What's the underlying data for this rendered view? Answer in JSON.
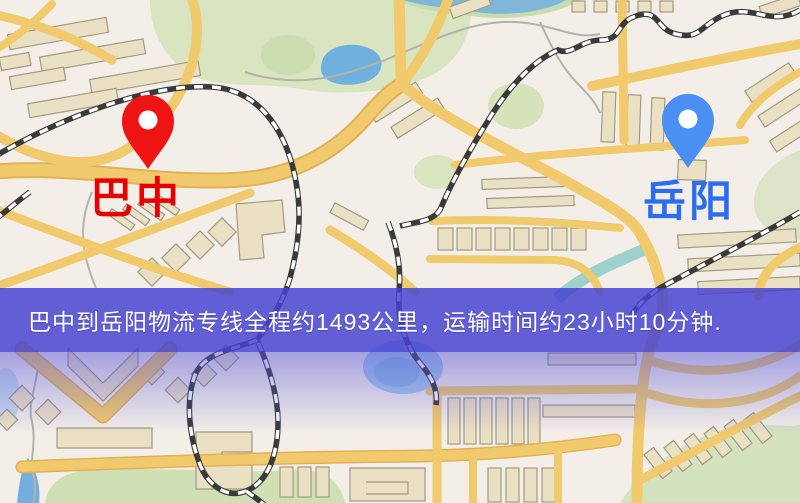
{
  "page": {
    "width_px": 800,
    "height_px": 503,
    "kind": "logistics route map image"
  },
  "map": {
    "markers": [
      {
        "id": "origin",
        "label": "巴中",
        "pin_color": "#ee1414",
        "label_color": "#e60202",
        "pin_style": "red teardrop with white hole"
      },
      {
        "id": "destination",
        "label": "岳阳",
        "pin_color": "#4a90f2",
        "label_color": "#2b6cf0",
        "pin_style": "blue teardrop with white hole"
      }
    ],
    "palette": {
      "background": "#f3efe8",
      "road": "#f0ca6c",
      "park": "#d9e4c0",
      "water": "#6fb0df",
      "building": "#eae0c4",
      "railway": "#3a3a3a"
    }
  },
  "banner": {
    "text": "巴中到岳阳物流专线全程约1493公里，运输时间约23小时10分钟.",
    "origin": "巴中",
    "destination": "岳阳",
    "distance_text": "约1493公里",
    "duration_text": "约23小时10分钟",
    "background_color": "#4642d2",
    "text_color": "#ffffff"
  }
}
